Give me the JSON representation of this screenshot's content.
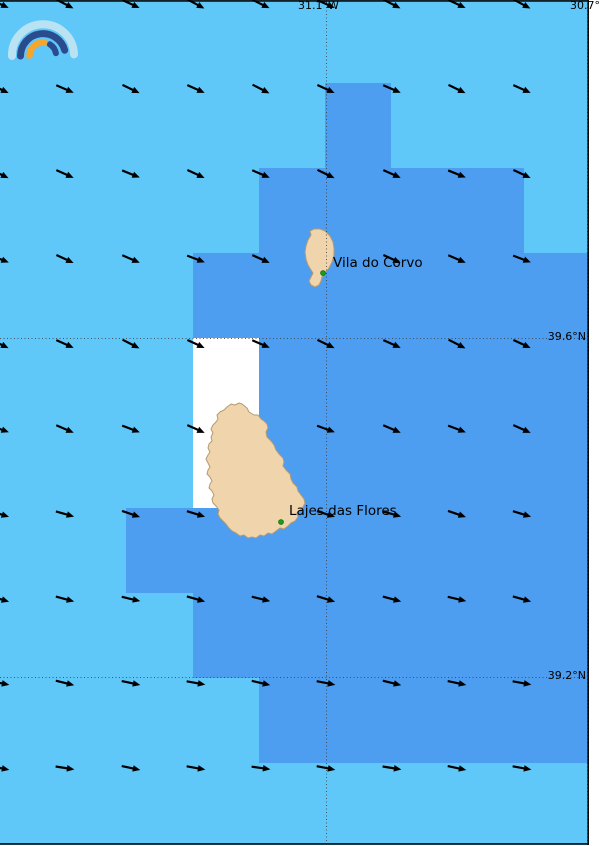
{
  "map": {
    "colors": {
      "ocean_light": "#5fc8f8",
      "ocean_dark": "#4d9df0",
      "land": "#f0d4ab",
      "land_outline": "#b59b72",
      "nodata_cell": "#ffffff",
      "grid_line": "#3c3c3c",
      "border": "#0a0a0a",
      "arrow": "#000000",
      "town_dot": "#17a017",
      "town_dot_edge": "#0a6a0a",
      "margin": "#ffffff"
    },
    "labels": {
      "lon_left": "31.1°W",
      "lon_right": "30.7°W",
      "lat_upper": "39.6°N",
      "lat_lower": "39.2°N",
      "town_corvo": "Vila do Corvo",
      "town_flores": "Lajes das Flores"
    },
    "grid": {
      "v_lines_x": [
        326,
        587
      ],
      "h_lines_y": [
        338,
        677
      ]
    },
    "cells": {
      "dark": [
        [
          325,
          83,
          66,
          85
        ],
        [
          259,
          168,
          265,
          85
        ],
        [
          193,
          253,
          397,
          85
        ],
        [
          259,
          338,
          331,
          170
        ],
        [
          126,
          508,
          464,
          85
        ],
        [
          193,
          593,
          397,
          85
        ],
        [
          259,
          678,
          331,
          85
        ]
      ],
      "nodata": [
        [
          193,
          338,
          66,
          170
        ]
      ]
    },
    "islands": {
      "corvo": {
        "name": "Corvo",
        "path": "M314,229 L310,231 311,235 308,240 306,246 305,252 306,259 308,265 311,270 313,273 311,277 309,281 311,285 315,287 319,285 321,281 322,277 325,273 329,268 332,262 334,255 334,248 333,242 330,236 325,231 320,229 Z",
        "town_dot": [
          323,
          273
        ]
      },
      "flores": {
        "name": "Flores",
        "path": "M242,404 L247,408 249,412 254,415 258,415 261,419 264,421 267,424 268,428 266,432 267,437 271,441 274,445 276,450 279,454 283,458 284,462 283,466 286,470 290,474 291,479 293,483 297,487 298,491 301,495 304,499 305,503 303,507 300,510 297,513 298,517 295,521 291,523 288,526 284,529 280,528 276,531 272,534 268,533 264,536 260,535 256,538 252,537 248,538 244,535 240,536 236,533 232,531 229,528 226,524 223,521 220,518 218,514 219,510 216,506 213,503 212,499 214,495 212,491 209,488 210,484 212,481 210,477 207,474 208,470 210,467 208,463 206,459 208,455 210,452 208,448 209,444 212,441 211,437 213,433 211,429 213,425 216,422 218,419 217,415 220,412 224,410 227,407 231,404 235,405 239,403 Z",
        "town_dot": [
          281,
          522
        ]
      }
    },
    "wind": {
      "direction": "ESE",
      "cols_x": [
        0,
        65,
        131,
        196,
        261,
        326,
        392,
        457,
        522
      ],
      "rows_y": [
        4,
        89,
        174,
        259,
        344,
        429,
        514,
        599,
        683,
        768,
        849
      ],
      "row_angles": [
        26,
        25,
        24,
        23,
        25,
        22,
        18,
        15,
        12,
        10,
        10
      ],
      "masked_nodes": [
        [
          5,
          3
        ],
        [
          4,
          5
        ],
        [
          4,
          6
        ]
      ]
    },
    "border": {
      "width": 1.6
    }
  },
  "logo": {
    "name": "rainbow-logo",
    "arcs": [
      {
        "id": "outer-pale-arc",
        "path": "M12,56 A31,31 0 0 1 74,54.4",
        "color": "#b9e3f3",
        "width": 8
      },
      {
        "id": "navy-long-arc",
        "path": "M20.5,56 A22.5,22.5 0 0 1 64.7,50.2",
        "color": "#2b4b8f",
        "width": 7
      },
      {
        "id": "navy-short-arc",
        "path": "M49.8,44.3 A13.5,13.5 0 0 1 55.9,53.2",
        "color": "#2b4b8f",
        "width": 6
      },
      {
        "id": "orange-arc",
        "path": "M29.5,55.5 A13.5,13.5 0 0 1 44.2,42.6",
        "color": "#f6a62a",
        "width": 6.5
      }
    ]
  }
}
